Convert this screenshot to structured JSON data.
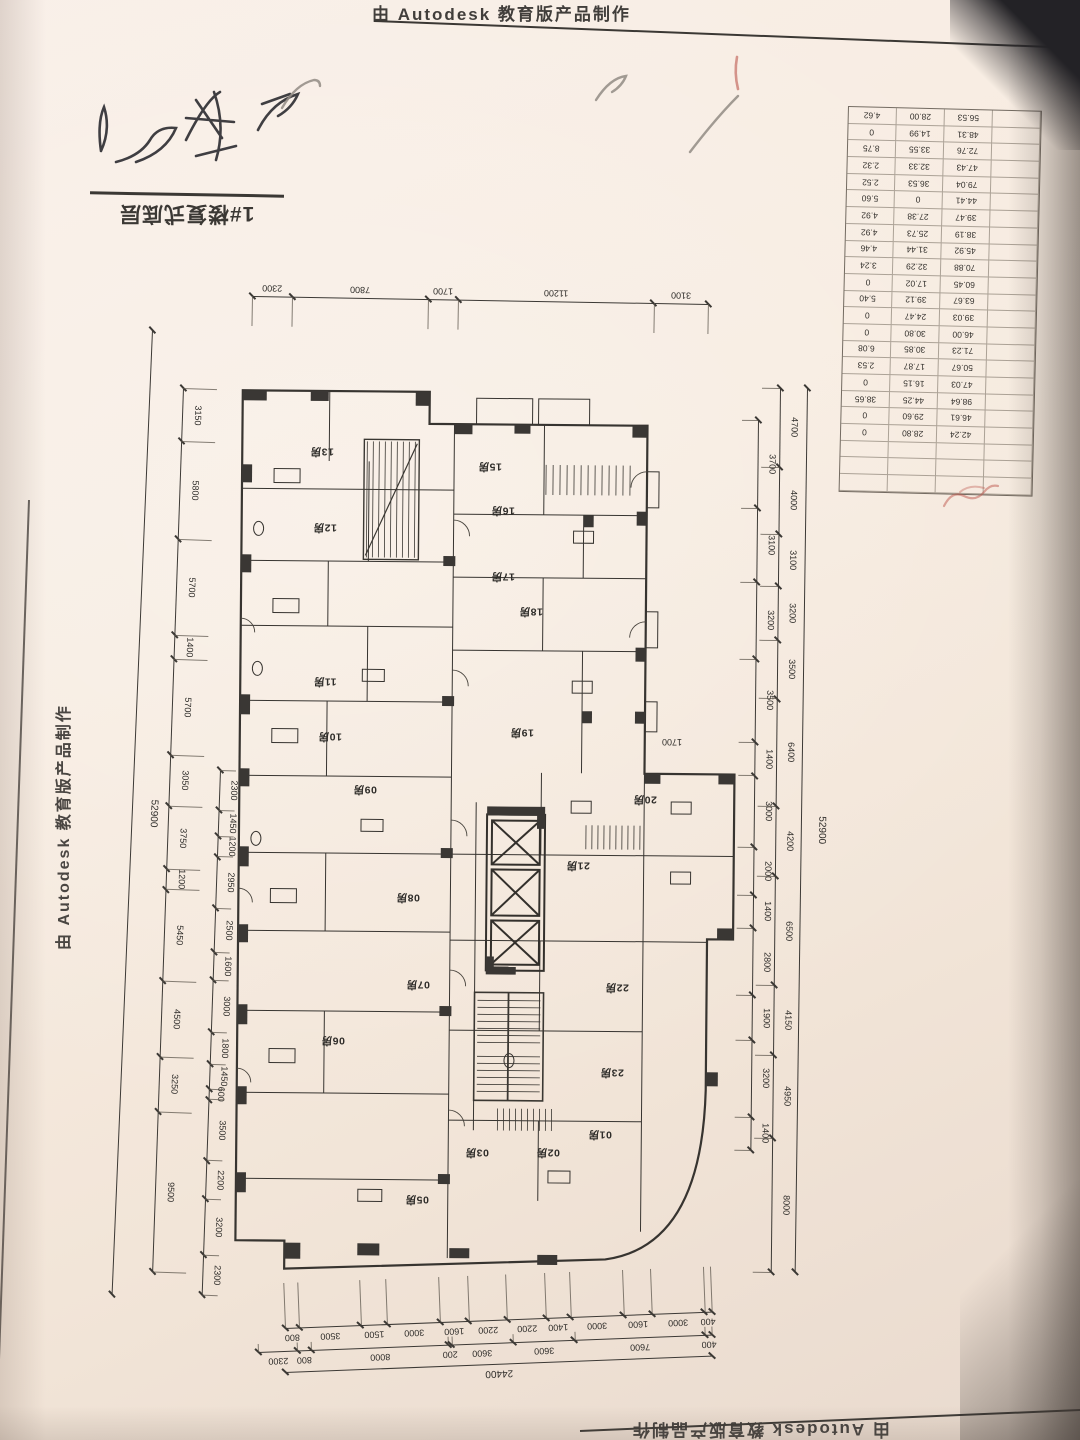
{
  "watermarks": {
    "top": "由 Autodesk 教育版产品制作",
    "left_vertical": "由 Autodesk 教育版产品制作",
    "bottom": "由 Autodesk 教育版产品制作"
  },
  "title_block": {
    "label": "1#楼复式底层"
  },
  "dimensions": {
    "top": [
      "2300",
      "7800",
      "1700",
      "11200",
      "3100"
    ],
    "left_outer": [
      "3150",
      "5800",
      "5700",
      "1400",
      "5700",
      "3050",
      "3750",
      "1200",
      "5450",
      "4500",
      "3250",
      "9500"
    ],
    "left_inner": [
      "2300",
      "1450",
      "1200",
      "2950",
      "2500",
      "1600",
      "3000",
      "1800",
      "1450",
      "600",
      "3500",
      "2200",
      "3200",
      "2300"
    ],
    "left_total": [
      "52900"
    ],
    "right_inner": [
      "3700",
      "3100",
      "3200",
      "3500",
      "1400",
      "3000",
      "2000",
      "1400",
      "2800",
      "1900",
      "3200",
      "1400"
    ],
    "right_outer": [
      "4700",
      "4000",
      "3100",
      "3200",
      "3500",
      "6400",
      "4200",
      "6500",
      "4150",
      "4950",
      "8000"
    ],
    "right_total": [
      "52900"
    ],
    "bottom_inner": [
      "800",
      "3500",
      "1500",
      "3000",
      "1600",
      "2200",
      "2200",
      "1400",
      "3000",
      "1600",
      "3000",
      "400"
    ],
    "bottom_outer": [
      "2300",
      "800",
      "8000",
      "200",
      "3600",
      "3600",
      "7600",
      "400"
    ],
    "bottom_total": [
      "24400"
    ]
  },
  "area_table": {
    "rows": [
      [
        "4.62",
        "28.00",
        "56.53"
      ],
      [
        "0",
        "14.99",
        "48.31"
      ],
      [
        "8.75",
        "33.55",
        "72.76"
      ],
      [
        "2.32",
        "32.33",
        "47.43"
      ],
      [
        "2.52",
        "36.53",
        "79.04"
      ],
      [
        "5.60",
        "0",
        "44.41"
      ],
      [
        "4.92",
        "27.38",
        "39.47"
      ],
      [
        "4.92",
        "25.73",
        "38.19"
      ],
      [
        "4.46",
        "31.44",
        "45.92"
      ],
      [
        "3.24",
        "32.29",
        "70.88"
      ],
      [
        "0",
        "17.02",
        "60.45"
      ],
      [
        "5.40",
        "39.12",
        "63.67"
      ],
      [
        "0",
        "24.47",
        "39.03"
      ],
      [
        "0",
        "30.80",
        "46.00"
      ],
      [
        "6.08",
        "30.85",
        "71.23"
      ],
      [
        "2.53",
        "17.87",
        "50.67"
      ],
      [
        "0",
        "16.15",
        "47.03"
      ],
      [
        "38.65",
        "44.25",
        "98.64"
      ],
      [
        "0",
        "29.60",
        "46.61"
      ],
      [
        "0",
        "28.80",
        "42.24"
      ],
      [
        "",
        "",
        ""
      ],
      [
        "",
        "",
        ""
      ],
      [
        "",
        "",
        ""
      ]
    ]
  },
  "plan": {
    "room_suffix": "房",
    "internal_dims": [
      {
        "text": "1700",
        "x": 672,
        "y": 742
      }
    ],
    "units": [
      {
        "no": "13",
        "x": 322,
        "y": 452
      },
      {
        "no": "12",
        "x": 325,
        "y": 528
      },
      {
        "no": "11",
        "x": 325,
        "y": 682
      },
      {
        "no": "10",
        "x": 330,
        "y": 737
      },
      {
        "no": "09",
        "x": 365,
        "y": 790
      },
      {
        "no": "08",
        "x": 408,
        "y": 898
      },
      {
        "no": "07",
        "x": 418,
        "y": 985
      },
      {
        "no": "06",
        "x": 333,
        "y": 1041
      },
      {
        "no": "05",
        "x": 417,
        "y": 1200
      },
      {
        "no": "03",
        "x": 477,
        "y": 1153
      },
      {
        "no": "02",
        "x": 548,
        "y": 1153
      },
      {
        "no": "01",
        "x": 600,
        "y": 1135
      },
      {
        "no": "15",
        "x": 490,
        "y": 467
      },
      {
        "no": "16",
        "x": 503,
        "y": 511
      },
      {
        "no": "17",
        "x": 503,
        "y": 577
      },
      {
        "no": "18",
        "x": 531,
        "y": 612
      },
      {
        "no": "19",
        "x": 522,
        "y": 733
      },
      {
        "no": "20",
        "x": 645,
        "y": 800
      },
      {
        "no": "21",
        "x": 578,
        "y": 866
      },
      {
        "no": "22",
        "x": 617,
        "y": 988
      },
      {
        "no": "23",
        "x": 612,
        "y": 1073
      }
    ]
  }
}
